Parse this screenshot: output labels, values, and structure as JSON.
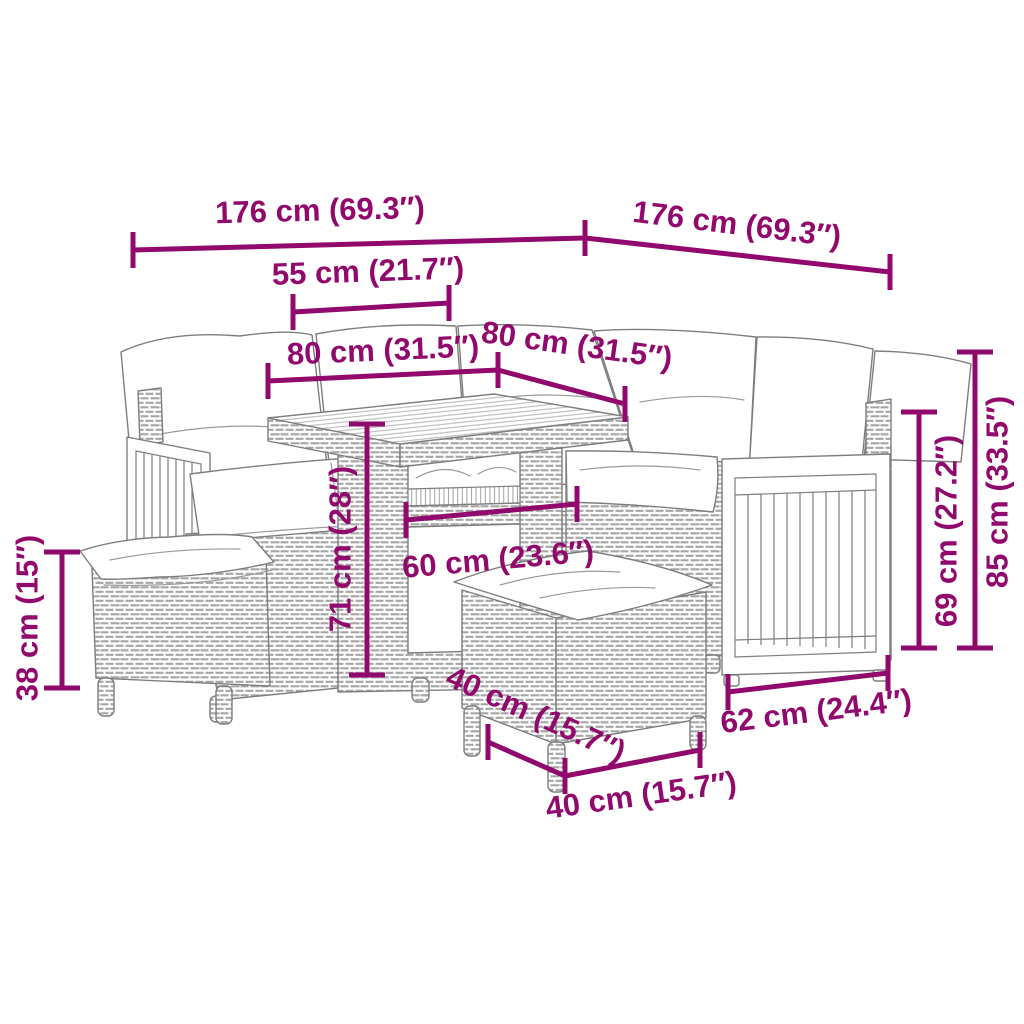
{
  "diagram": {
    "depicts": "Poly rattan garden corner sofa set with cushions, dining table and two stools, annotated with product dimensions",
    "background": "#ffffff",
    "accent_color": "#92096d",
    "furniture_line_color": "#7e7e7e"
  },
  "dimensions": {
    "sofa_length_left": {
      "label": "176 cm (69.3″)",
      "cm": 176,
      "inches": 69.3
    },
    "sofa_length_right": {
      "label": "176 cm (69.3″)",
      "cm": 176,
      "inches": 69.3
    },
    "table_offset": {
      "label": "55 cm (21.7″)",
      "cm": 55,
      "inches": 21.7
    },
    "seat_depth_left": {
      "label": "80 cm (31.5″)",
      "cm": 80,
      "inches": 31.5
    },
    "seat_depth_right": {
      "label": "80 cm (31.5″)",
      "cm": 80,
      "inches": 31.5
    },
    "table_height": {
      "label": "71 cm (28″)",
      "cm": 71,
      "inches": 28
    },
    "table_width": {
      "label": "60 cm (23.6″)",
      "cm": 60,
      "inches": 23.6
    },
    "stool_height": {
      "label": "38 cm (15″)",
      "cm": 38,
      "inches": 15
    },
    "backrest_height": {
      "label": "69 cm (27.2″)",
      "cm": 69,
      "inches": 27.2
    },
    "total_height": {
      "label": "85 cm (33.5″)",
      "cm": 85,
      "inches": 33.5
    },
    "armrest_depth": {
      "label": "62 cm (24.4″)",
      "cm": 62,
      "inches": 24.4
    },
    "stool_depth": {
      "label": "40 cm (15.7″)",
      "cm": 40,
      "inches": 15.7
    },
    "stool_width": {
      "label": "40 cm (15.7″)",
      "cm": 40,
      "inches": 15.7
    }
  }
}
